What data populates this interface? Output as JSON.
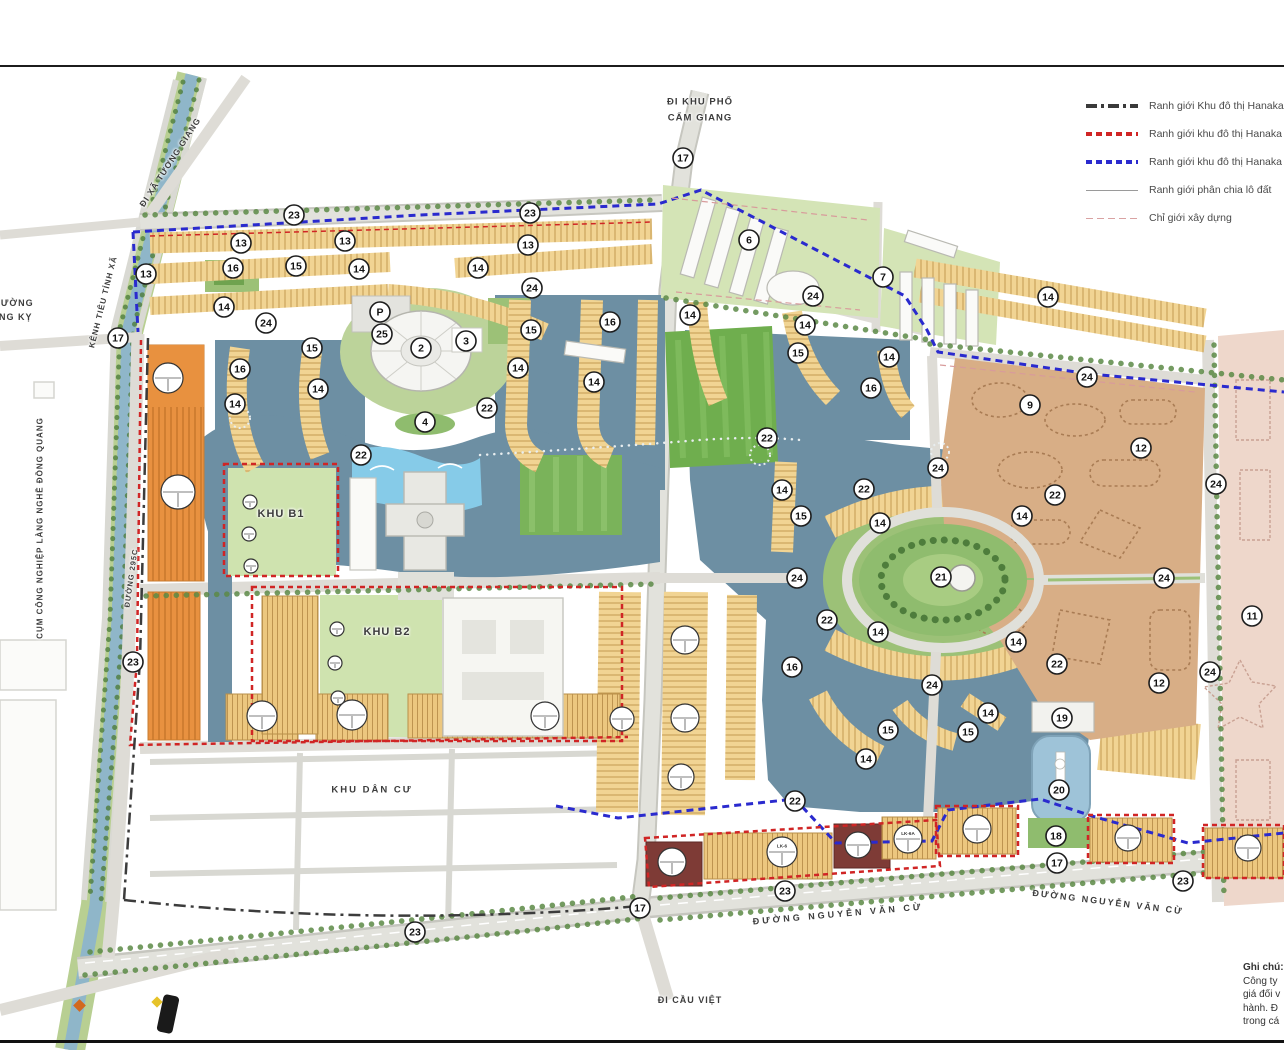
{
  "legend": {
    "items": [
      {
        "style": "dashdot-black",
        "label": "Ranh giới Khu đô thị Hanaka - H"
      },
      {
        "style": "dashed-red",
        "label": "Ranh giới khu đô thị Hanaka đã p"
      },
      {
        "style": "dashed-blue",
        "label": "Ranh giới khu đô thị Hanaka mở"
      },
      {
        "style": "solid-gray",
        "label": "Ranh giới phân chia lô đất"
      },
      {
        "style": "dashed-pink",
        "label": "Chỉ giới xây dựng"
      }
    ]
  },
  "notes": {
    "title": "Ghi chú:",
    "lines": [
      "Công ty",
      "giá đối v",
      "hành. Đ",
      "trong cá"
    ]
  },
  "map_labels": [
    {
      "id": "di-xa-tuong-giang",
      "text": "ĐI XÃ TƯƠNG GIANG",
      "x": 170,
      "y": 162,
      "rot": -57,
      "fs": 8.5,
      "ls": 1
    },
    {
      "id": "kenh-tieu-tinh-xa",
      "text": "KÊNH TIÊU TỈNH XÃ",
      "x": 103,
      "y": 302,
      "rot": -76,
      "fs": 8,
      "ls": 1
    },
    {
      "id": "phuong-dong-ky-line1",
      "text": "PHƯỜNG",
      "x": 10,
      "y": 303,
      "rot": 0,
      "fs": 9,
      "ls": 1
    },
    {
      "id": "phuong-dong-ky-line2",
      "text": "ĐỒNG KỴ",
      "x": 8,
      "y": 317,
      "rot": 0,
      "fs": 9,
      "ls": 1
    },
    {
      "id": "cum-cong-nghiep-lang-nghe-dong-quang",
      "text": "CỤM CÔNG NGHIỆP LÀNG NGHỀ ĐỒNG QUANG",
      "x": 40,
      "y": 528,
      "rot": -90,
      "fs": 8,
      "ls": 1
    },
    {
      "id": "duong-295c",
      "text": "ĐƯỜNG 295C",
      "x": 131,
      "y": 578,
      "rot": -82,
      "fs": 7.5,
      "ls": 1
    },
    {
      "id": "di-khu-pho",
      "text": "ĐI KHU PHỐ",
      "x": 700,
      "y": 102,
      "rot": 0,
      "fs": 9.5,
      "ls": 1
    },
    {
      "id": "cam-giang",
      "text": "CẨM GIANG",
      "x": 700,
      "y": 118,
      "rot": 0,
      "fs": 9.5,
      "ls": 1
    },
    {
      "id": "khu-b1",
      "text": "KHU B1",
      "x": 281,
      "y": 514,
      "rot": 0,
      "fs": 11,
      "ls": 1
    },
    {
      "id": "khu-b2",
      "text": "KHU B2",
      "x": 387,
      "y": 632,
      "rot": 0,
      "fs": 11,
      "ls": 1
    },
    {
      "id": "khu-dan-cu",
      "text": "KHU DÂN CƯ",
      "x": 372,
      "y": 790,
      "rot": 0,
      "fs": 9.5,
      "ls": 2
    },
    {
      "id": "duong-nguyen-van-cu-1",
      "text": "ĐƯỜNG NGUYỄN VĂN CỪ",
      "x": 838,
      "y": 914,
      "rot": -5,
      "fs": 9,
      "ls": 3
    },
    {
      "id": "duong-nguyen-van-cu-2",
      "text": "ĐƯỜNG NGUYỄN VĂN CỪ",
      "x": 1108,
      "y": 902,
      "rot": 7,
      "fs": 9,
      "ls": 2
    },
    {
      "id": "di-cau-viet",
      "text": "ĐI CẦU VIỆT",
      "x": 690,
      "y": 1000,
      "rot": 0,
      "fs": 9,
      "ls": 1
    }
  ],
  "markers": [
    {
      "n": "17",
      "x": 683,
      "y": 158
    },
    {
      "n": "23",
      "x": 294,
      "y": 215
    },
    {
      "n": "23",
      "x": 530,
      "y": 213
    },
    {
      "n": "13",
      "x": 146,
      "y": 274
    },
    {
      "n": "13",
      "x": 241,
      "y": 243
    },
    {
      "n": "13",
      "x": 345,
      "y": 241
    },
    {
      "n": "13",
      "x": 528,
      "y": 245
    },
    {
      "n": "16",
      "x": 233,
      "y": 268
    },
    {
      "n": "15",
      "x": 296,
      "y": 266
    },
    {
      "n": "14",
      "x": 359,
      "y": 269
    },
    {
      "n": "14",
      "x": 478,
      "y": 268
    },
    {
      "n": "24",
      "x": 532,
      "y": 288
    },
    {
      "n": "24",
      "x": 266,
      "y": 323
    },
    {
      "n": "14",
      "x": 224,
      "y": 307
    },
    {
      "n": "15",
      "x": 312,
      "y": 348
    },
    {
      "n": "16",
      "x": 240,
      "y": 369
    },
    {
      "n": "14",
      "x": 318,
      "y": 389
    },
    {
      "n": "14",
      "x": 235,
      "y": 404
    },
    {
      "n": "P",
      "x": 380,
      "y": 312
    },
    {
      "n": "25",
      "x": 382,
      "y": 334
    },
    {
      "n": "2",
      "x": 421,
      "y": 348
    },
    {
      "n": "3",
      "x": 466,
      "y": 341
    },
    {
      "n": "15",
      "x": 531,
      "y": 330
    },
    {
      "n": "14",
      "x": 518,
      "y": 368
    },
    {
      "n": "14",
      "x": 594,
      "y": 382
    },
    {
      "n": "16",
      "x": 610,
      "y": 322
    },
    {
      "n": "4",
      "x": 425,
      "y": 422
    },
    {
      "n": "22",
      "x": 487,
      "y": 408
    },
    {
      "n": "22",
      "x": 361,
      "y": 455
    },
    {
      "n": "6",
      "x": 749,
      "y": 240
    },
    {
      "n": "7",
      "x": 883,
      "y": 277
    },
    {
      "n": "24",
      "x": 813,
      "y": 296
    },
    {
      "n": "14",
      "x": 690,
      "y": 315
    },
    {
      "n": "14",
      "x": 805,
      "y": 325
    },
    {
      "n": "15",
      "x": 798,
      "y": 353
    },
    {
      "n": "14",
      "x": 889,
      "y": 357
    },
    {
      "n": "16",
      "x": 871,
      "y": 388
    },
    {
      "n": "14",
      "x": 1048,
      "y": 297
    },
    {
      "n": "22",
      "x": 767,
      "y": 438
    },
    {
      "n": "24",
      "x": 1087,
      "y": 377
    },
    {
      "n": "9",
      "x": 1030,
      "y": 405
    },
    {
      "n": "12",
      "x": 1141,
      "y": 448
    },
    {
      "n": "24",
      "x": 1216,
      "y": 484
    },
    {
      "n": "22",
      "x": 1055,
      "y": 495
    },
    {
      "n": "14",
      "x": 1022,
      "y": 516
    },
    {
      "n": "22",
      "x": 864,
      "y": 489
    },
    {
      "n": "14",
      "x": 782,
      "y": 490
    },
    {
      "n": "15",
      "x": 801,
      "y": 516
    },
    {
      "n": "14",
      "x": 880,
      "y": 523
    },
    {
      "n": "21",
      "x": 941,
      "y": 577
    },
    {
      "n": "24",
      "x": 938,
      "y": 468
    },
    {
      "n": "24",
      "x": 797,
      "y": 578
    },
    {
      "n": "24",
      "x": 1164,
      "y": 578
    },
    {
      "n": "11",
      "x": 1252,
      "y": 616
    },
    {
      "n": "22",
      "x": 827,
      "y": 620
    },
    {
      "n": "14",
      "x": 878,
      "y": 632
    },
    {
      "n": "14",
      "x": 1016,
      "y": 642
    },
    {
      "n": "22",
      "x": 1057,
      "y": 664
    },
    {
      "n": "24",
      "x": 1210,
      "y": 672
    },
    {
      "n": "12",
      "x": 1159,
      "y": 683
    },
    {
      "n": "16",
      "x": 792,
      "y": 667
    },
    {
      "n": "24",
      "x": 932,
      "y": 685
    },
    {
      "n": "14",
      "x": 988,
      "y": 713
    },
    {
      "n": "19",
      "x": 1062,
      "y": 718
    },
    {
      "n": "15",
      "x": 888,
      "y": 730
    },
    {
      "n": "15",
      "x": 968,
      "y": 732
    },
    {
      "n": "14",
      "x": 866,
      "y": 759
    },
    {
      "n": "20",
      "x": 1059,
      "y": 790
    },
    {
      "n": "22",
      "x": 795,
      "y": 801
    },
    {
      "n": "18",
      "x": 1056,
      "y": 836
    },
    {
      "n": "17",
      "x": 1057,
      "y": 863
    },
    {
      "n": "23",
      "x": 1183,
      "y": 881
    },
    {
      "n": "17",
      "x": 640,
      "y": 908
    },
    {
      "n": "23",
      "x": 785,
      "y": 891
    },
    {
      "n": "23",
      "x": 415,
      "y": 932
    },
    {
      "n": "17",
      "x": 118,
      "y": 338
    },
    {
      "n": "23",
      "x": 133,
      "y": 662
    }
  ],
  "lot_circles": [
    {
      "x": 168,
      "y": 378,
      "r": 15,
      "code": ""
    },
    {
      "x": 178,
      "y": 492,
      "r": 17,
      "code": ""
    },
    {
      "x": 262,
      "y": 716,
      "r": 15,
      "code": ""
    },
    {
      "x": 352,
      "y": 715,
      "r": 15,
      "code": ""
    },
    {
      "x": 545,
      "y": 716,
      "r": 14,
      "code": ""
    },
    {
      "x": 622,
      "y": 719,
      "r": 12,
      "code": ""
    },
    {
      "x": 685,
      "y": 640,
      "r": 14,
      "code": ""
    },
    {
      "x": 685,
      "y": 718,
      "r": 14,
      "code": ""
    },
    {
      "x": 681,
      "y": 777,
      "r": 13,
      "code": ""
    },
    {
      "x": 672,
      "y": 862,
      "r": 14,
      "code": ""
    },
    {
      "x": 782,
      "y": 852,
      "r": 15,
      "code": "LK-6"
    },
    {
      "x": 858,
      "y": 845,
      "r": 13,
      "code": ""
    },
    {
      "x": 908,
      "y": 839,
      "r": 14,
      "code": "LK-6A"
    },
    {
      "x": 977,
      "y": 829,
      "r": 14,
      "code": ""
    },
    {
      "x": 1128,
      "y": 838,
      "r": 13,
      "code": ""
    },
    {
      "x": 1248,
      "y": 848,
      "r": 13,
      "code": ""
    },
    {
      "x": 250,
      "y": 502,
      "r": 7,
      "code": ""
    },
    {
      "x": 249,
      "y": 534,
      "r": 7,
      "code": ""
    },
    {
      "x": 251,
      "y": 566,
      "r": 7,
      "code": ""
    },
    {
      "x": 337,
      "y": 629,
      "r": 7,
      "code": ""
    },
    {
      "x": 335,
      "y": 663,
      "r": 7,
      "code": ""
    },
    {
      "x": 338,
      "y": 698,
      "r": 7,
      "code": ""
    }
  ],
  "colors": {
    "water": "#6d8fa3",
    "canal": "#8fb6c9",
    "green": "#85b564",
    "tan_strip": "#f1d493",
    "orange_block": "#e89140",
    "brown_zone": "#d8ae86",
    "pink_zone": "#eed7cb",
    "dark_red_block": "#7e3b36",
    "boundary_blue": "#2a2ace",
    "boundary_red": "#d02525",
    "boundary_black": "#3c3c3c",
    "road": "#e0e0da"
  }
}
